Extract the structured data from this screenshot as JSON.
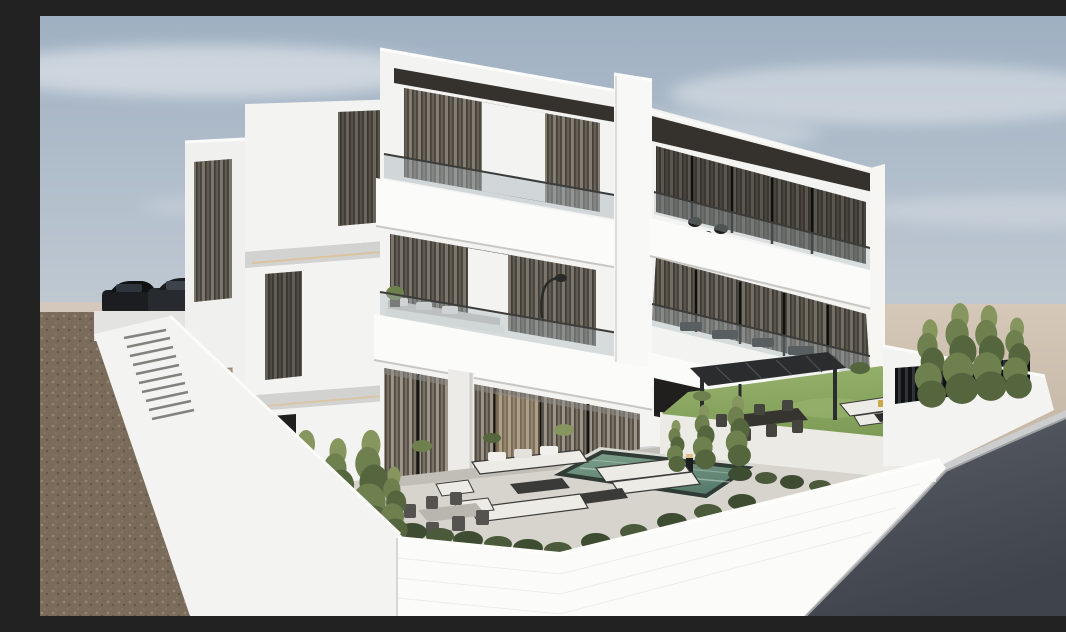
{
  "meta": {
    "title": "Modern villa exterior render",
    "description": "3D architectural rendering of a modern three-storey white residential villa with glass-railing balconies, dark roof fascia, floor-to-ceiling glazing with sheer drapes, a front terrace with swimming pool, outdoor lounge and dining furniture, a dark pergola over a dining area, a raised lawn, cypress trees and white perimeter walls; a gravel lot with an exterior staircase and two parked cars on the left, sand terrain and a curved asphalt road on the right under a soft cloudy sky.",
    "render_type": "architectural-render",
    "text_on_image": ""
  },
  "scene": {
    "building": {
      "storeys": 3,
      "style": "modern minimalist, white stone cladding",
      "features": [
        "dark roof fascia band",
        "recessed top-floor terrace",
        "glass balustrade balconies",
        "vertical sheer curtains",
        "round facade column",
        "rooftop stair tower",
        "warm cove lighting under slabs"
      ]
    },
    "yard": {
      "elements": [
        "swimming pool",
        "pool coping",
        "lounge sofa set",
        "coffee tables",
        "outdoor dining set",
        "pergola with dining area",
        "raised lawn platform",
        "lawn corner sofa with fire table",
        "hedge rows",
        "shrubs",
        "pathway lamp"
      ]
    },
    "vegetation": {
      "cypress_trees": 11,
      "hedge_clusters": 14
    },
    "surroundings": {
      "left": "brown gravel lot with white retaining wall and exterior staircase, two dark parked cars",
      "right": "beige sand terrain, white boundary wall with black slatted fence, curved asphalt road with light curb",
      "sky": "pale blue-grey with soft cloud streaks"
    },
    "vehicles": {
      "count": 2,
      "type": "dark SUVs behind wall"
    }
  },
  "colors": {
    "sky_top": "#9fb0c2",
    "sky_mid": "#bdc7d1",
    "sky_low": "#d7d7d6",
    "cloud": "#eef1f3",
    "sand": "#d5c8b8",
    "sand_dark": "#c3b4a2",
    "dirt": "#7a6b5b",
    "dirt_light": "#a5947e",
    "dirt_dark": "#57493b",
    "road": "#5b6068",
    "road_dark": "#3f434b",
    "curb": "#cbcdce",
    "curb_shadow": "#9fa1a3",
    "wall_white": "#f3f3f1",
    "wall_bright": "#fbfbfa",
    "wall_shade": "#e3e4e2",
    "wall_dim": "#d2d3d1",
    "fascia": "#35322d",
    "roof_dark": "#262420",
    "glass_dark": "#201f1d",
    "frame_dark": "#161614",
    "curtain_light": "#c6bbaa",
    "curtain_mid": "#958c7c",
    "curtain_dark": "#5a554c",
    "warm_light": "#e0bd8a",
    "railing_glass": "#a9b6bd",
    "railing_frame": "#3c3c3b",
    "terrace": "#d7d4ce",
    "terrace_shade": "#b8b5af",
    "lawn": "#7e9c57",
    "lawn_light": "#97b26c",
    "pool_deep": "#587c6c",
    "pool_light": "#7fa18d",
    "pool_edge": "#303b35",
    "tree_dark": "#55663f",
    "tree_mid": "#6e804e",
    "tree_light": "#87965f",
    "trunk": "#6b5f4d",
    "hedge": "#3e4c31",
    "furn_white": "#ecebe6",
    "furn_grey": "#c9c7c1",
    "furn_frame": "#3a3a38",
    "pergola": "#2b2c2d",
    "car_dark": "#1b1d20",
    "car_mid": "#272a2e",
    "car_glass": "#3c434b",
    "tail_red": "#a03228",
    "door_tan": "#b3a493"
  }
}
